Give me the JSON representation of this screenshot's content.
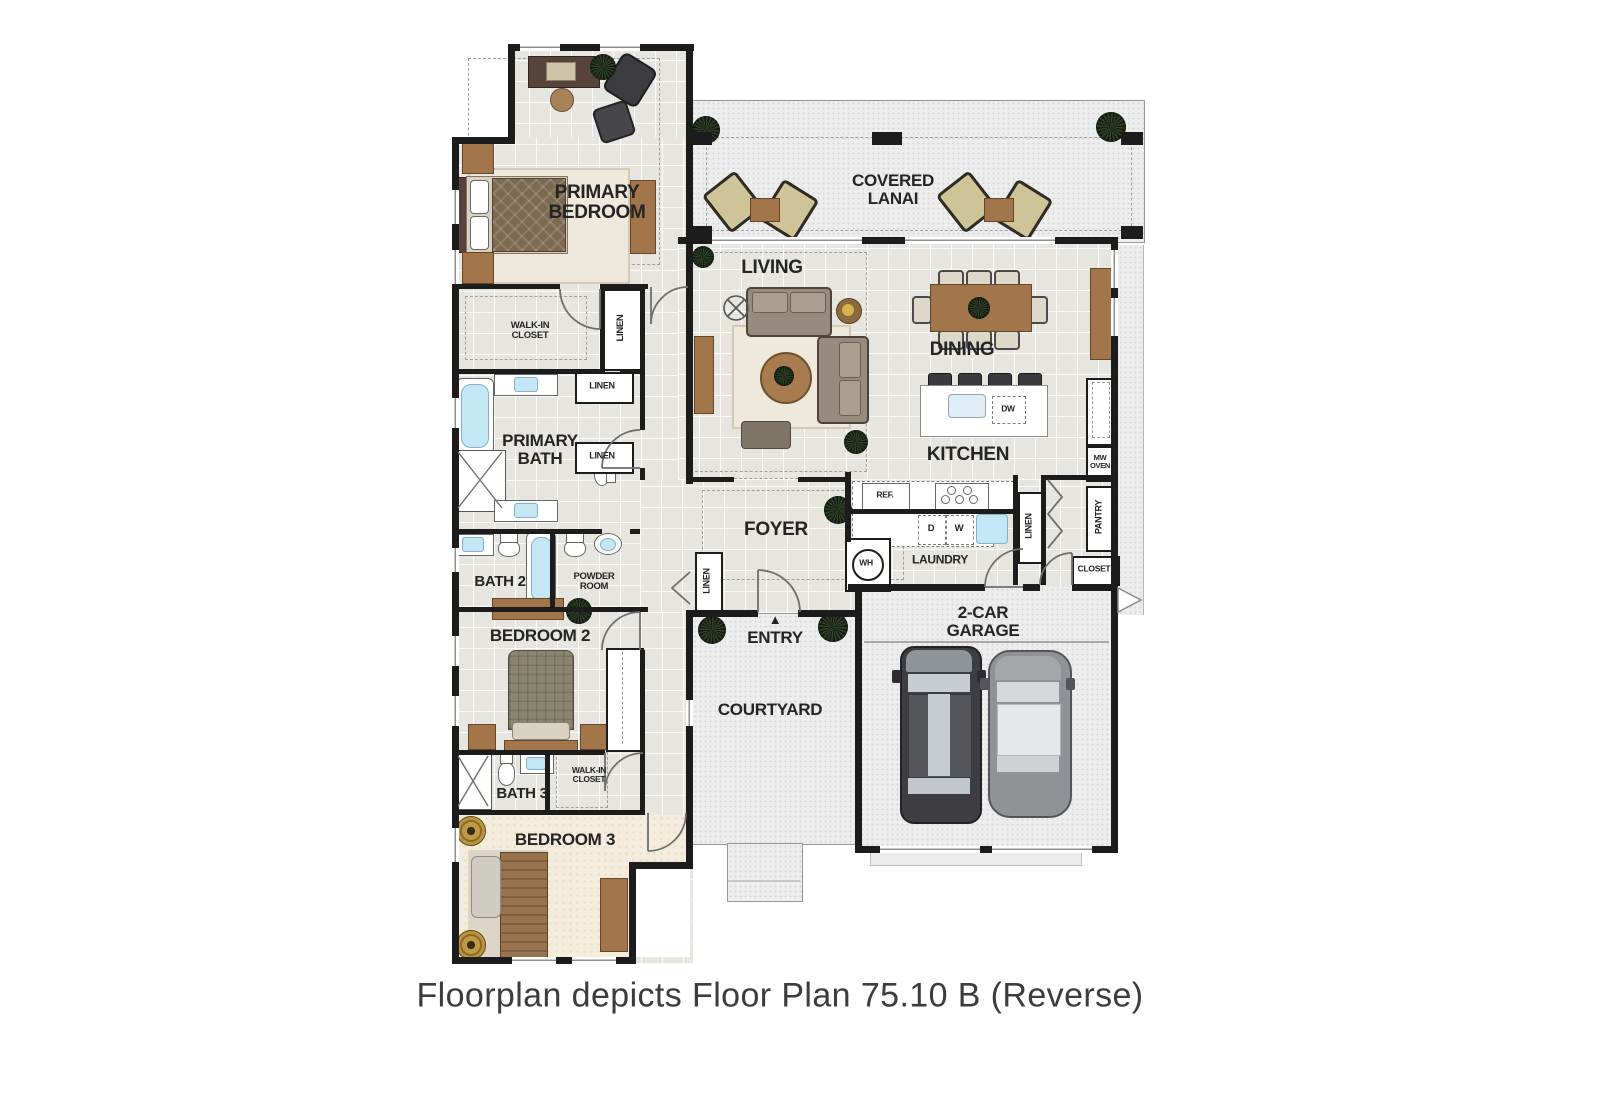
{
  "caption": "Floorplan depicts Floor Plan 75.10 B (Reverse)",
  "colors": {
    "wall": "#1c1c1c",
    "tile_floor": "#e7e5e0",
    "carpet_floor": "#f4ecdc",
    "outdoor_floor": "#ededed",
    "wood_accent": "#a2764a",
    "fixture_blue": "#c5e6f4",
    "label_text": "#242424"
  },
  "labels": {
    "primary_bedroom": "PRIMARY\nBEDROOM",
    "covered_lanai": "COVERED\nLANAI",
    "living": "LIVING",
    "dining": "DINING",
    "kitchen": "KITCHEN",
    "walk_in_closet_primary": "WALK-IN\nCLOSET",
    "linen_wic": "LINEN",
    "linen_bath_upper": "LINEN",
    "linen_bath_lower": "LINEN",
    "primary_bath": "PRIMARY\nBATH",
    "bath2": "BATH 2",
    "powder_room": "POWDER\nROOM",
    "bedroom2": "BEDROOM 2",
    "foyer": "FOYER",
    "linen_foyer": "LINEN",
    "water_heater": "WH",
    "laundry": "LAUNDRY",
    "ref": "REF.",
    "dryer": "D",
    "washer": "W",
    "dishwasher": "DW",
    "linen_kitchen": "LINEN",
    "mw_oven": "MW\nOVEN",
    "pantry": "PANTRY",
    "closet": "CLOSET",
    "entry": "ENTRY",
    "entry_marker": "▲",
    "courtyard": "COURTYARD",
    "garage": "2-CAR\nGARAGE",
    "bath3": "BATH 3",
    "walk_in_closet_3": "WALK-IN\nCLOSET",
    "bedroom3": "BEDROOM 3"
  }
}
